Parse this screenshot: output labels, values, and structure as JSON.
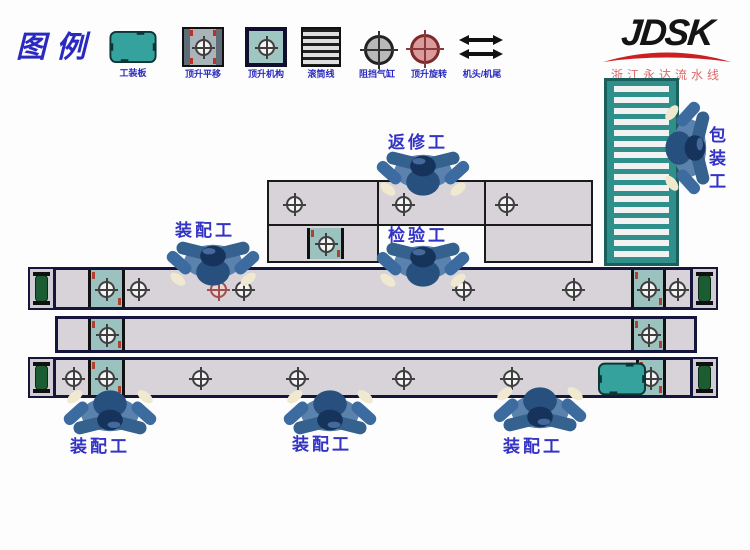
{
  "legend": {
    "title": "图例",
    "items": [
      {
        "name": "tooling-plate",
        "label": "工装板"
      },
      {
        "name": "lift-translate",
        "label": "顶升平移"
      },
      {
        "name": "lift-mechanism",
        "label": "顶升机构"
      },
      {
        "name": "roller-line",
        "label": "滚筒线"
      },
      {
        "name": "stop-cylinder",
        "label": "阻挡气缸"
      },
      {
        "name": "lift-rotate",
        "label": "顶升旋转"
      },
      {
        "name": "head-tail",
        "label": "机头/机尾"
      }
    ]
  },
  "logo": {
    "brand": "JDSK",
    "subtitle": "浙江永达流水线"
  },
  "stations": {
    "rework": "返修工",
    "assembly_top": "装配工",
    "inspect": "检验工",
    "packing": "包装工",
    "assembly_b1": "装配工",
    "assembly_b2": "装配工",
    "assembly_b3": "装配工"
  },
  "colors": {
    "teal": "#35a29d",
    "lane_fill": "#d7d3d9",
    "border_navy": "#16163c",
    "label_blue": "#3333c6",
    "logo_red": "#cc2020",
    "worker_blue": "#3c6ba0"
  }
}
